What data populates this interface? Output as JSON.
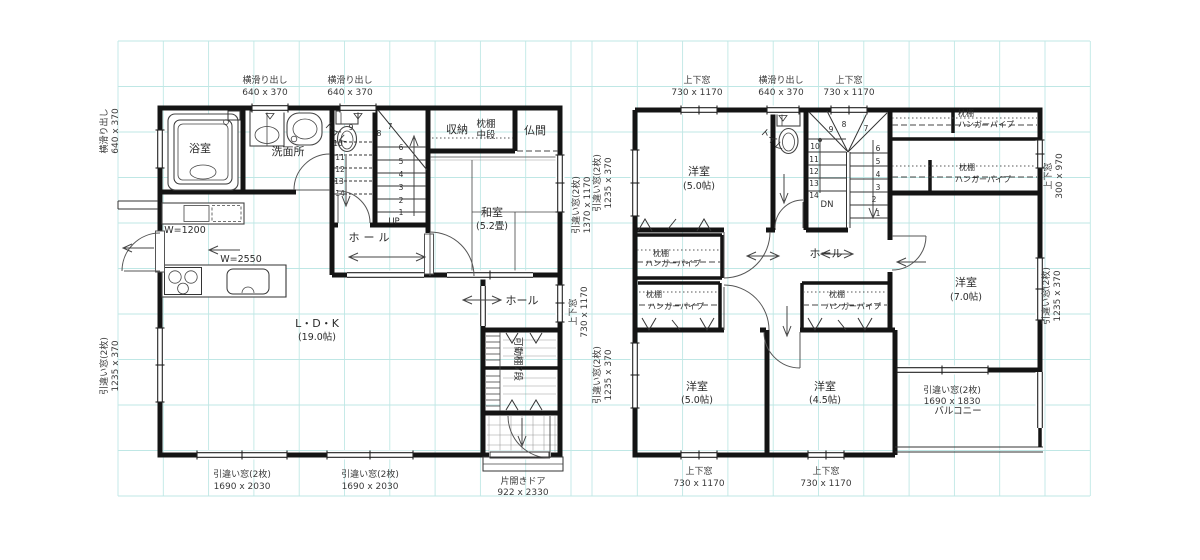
{
  "floor1": {
    "rooms": {
      "bath": "浴室",
      "wash": "洗面所",
      "toilet": "トイレ",
      "storage": "収納",
      "storage_shelf_line1": "枕棚",
      "storage_shelf_line2": "中段",
      "butsuma": "仏間",
      "washitsu": "和室",
      "washitsu_size": "(5.2畳)",
      "hall_upper": "ホール",
      "hall_lower": "ホール",
      "ldk": "L・D・K",
      "ldk_size": "(19.0帖)",
      "shoe_shelf": "可動棚7段"
    },
    "labels": {
      "counter_sink": "W=1200",
      "counter_kitchen": "W=2550",
      "up": "UP"
    },
    "entrance": {
      "door": "片開きドア",
      "door_size": "922 x 2330"
    },
    "stairs": {
      "right": [
        "1",
        "2",
        "3",
        "4",
        "5",
        "6"
      ],
      "turn": [
        "7",
        "8"
      ],
      "left": [
        "9",
        "10",
        "11",
        "12",
        "13",
        "14"
      ]
    },
    "windows": {
      "top_wash": {
        "type": "横滑り出し",
        "size": "640 x 370"
      },
      "top_toilet": {
        "type": "横滑り出し",
        "size": "640 x 370"
      },
      "left_bath": {
        "type": "横滑り出し",
        "size": "640 x 370"
      },
      "left_ldk": {
        "type": "引違い窓(2枚)",
        "size": "1235 x 370"
      },
      "bottom_ldk_left": {
        "type": "引違い窓(2枚)",
        "size": "1690 x 2030"
      },
      "bottom_ldk_right": {
        "type": "引違い窓(2枚)",
        "size": "1690 x 2030"
      },
      "right_washitsu": {
        "type": "引違い窓(2枚)",
        "size": "1370 x 1170"
      },
      "right_hall": {
        "type": "上下窓",
        "size": "730 x 1170"
      }
    }
  },
  "floor2": {
    "rooms": {
      "bed_nw": "洋室",
      "bed_nw_size": "(5.0帖)",
      "toilet": "トイレ",
      "hall": "ホール",
      "bed_e": "洋室",
      "bed_e_size": "(7.0帖)",
      "bed_sw": "洋室",
      "bed_sw_size": "(5.0帖)",
      "bed_s": "洋室",
      "bed_s_size": "(4.5帖)",
      "balcony": "バルコニー"
    },
    "labels": {
      "dn": "DN"
    },
    "closets": [
      {
        "shelf": "枕棚",
        "pipe": "ハンガーパイプ"
      },
      {
        "shelf": "枕棚",
        "pipe": "ハンガーパイプ"
      },
      {
        "shelf": "枕棚",
        "pipe": "ハンガーパイプ"
      },
      {
        "shelf": "枕棚",
        "pipe": "ハンガーパイプ"
      },
      {
        "shelf": "枕棚",
        "pipe": "ハンガーパイプ"
      }
    ],
    "stairs": {
      "left": [
        "9",
        "10",
        "11",
        "12",
        "13",
        "14"
      ],
      "turn": [
        "8",
        "7"
      ],
      "right": [
        "6",
        "5",
        "4",
        "3",
        "2",
        "1"
      ]
    },
    "windows": {
      "top_bed_nw": {
        "type": "上下窓",
        "size": "730 x 1170"
      },
      "top_toilet": {
        "type": "横滑り出し",
        "size": "640 x 370"
      },
      "top_stairs": {
        "type": "上下窓",
        "size": "730 x 1170"
      },
      "left_bed_nw": {
        "type": "引違い窓(2枚)",
        "size": "1235 x 370"
      },
      "left_bed_sw": {
        "type": "引違い窓(2枚)",
        "size": "1235 x 370"
      },
      "right_closet": {
        "type": "上下窓",
        "size": "300 x 970"
      },
      "right_bed_e": {
        "type": "引違い窓(2枚)",
        "size": "1235 x 370"
      },
      "bottom_bed_sw": {
        "type": "上下窓",
        "size": "730 x 1170"
      },
      "bottom_bed_s": {
        "type": "上下窓",
        "size": "730 x 1170"
      },
      "balcony": {
        "type": "引違い窓(2枚)",
        "size": "1690 x 1830"
      }
    }
  }
}
